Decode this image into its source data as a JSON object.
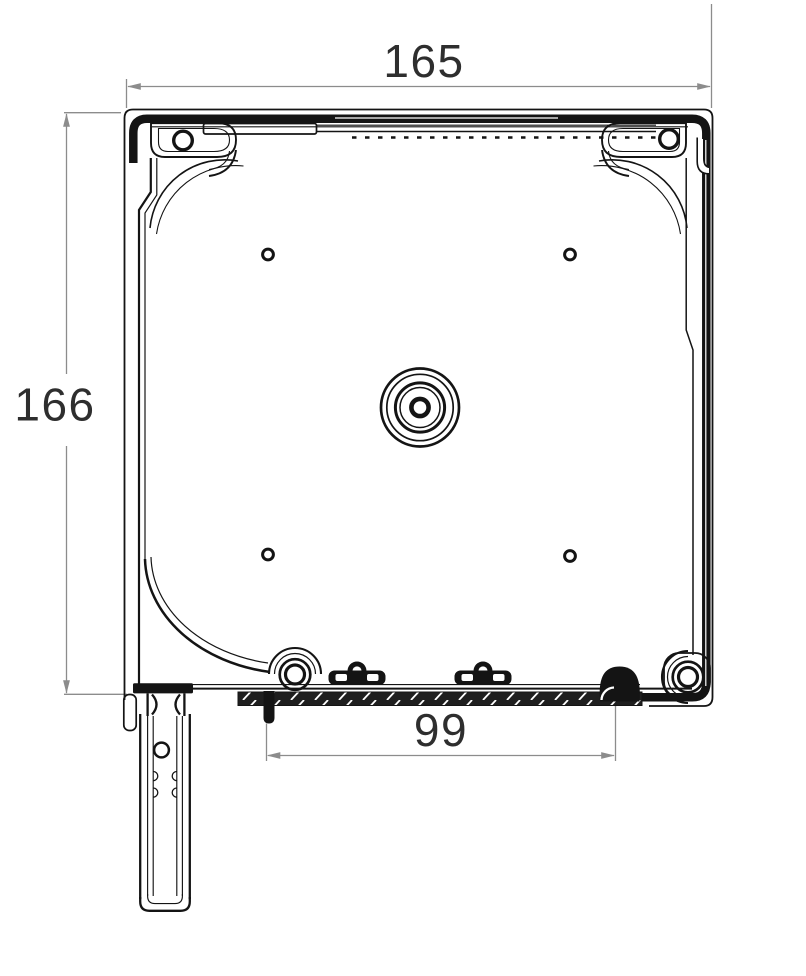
{
  "drawing": {
    "kind": "technical-drawing",
    "subject": "roller-shutter-box-cross-section",
    "dimensions": {
      "top_width": {
        "value": "165"
      },
      "left_height": {
        "value": "166"
      },
      "bottom_width": {
        "value": "99"
      }
    },
    "colors": {
      "line": "#141414",
      "dimension_line": "#8c8c8c",
      "dimension_text": "#2e2e2e",
      "hatch_fill": "#1f1f1f",
      "background": "#ffffff"
    }
  }
}
